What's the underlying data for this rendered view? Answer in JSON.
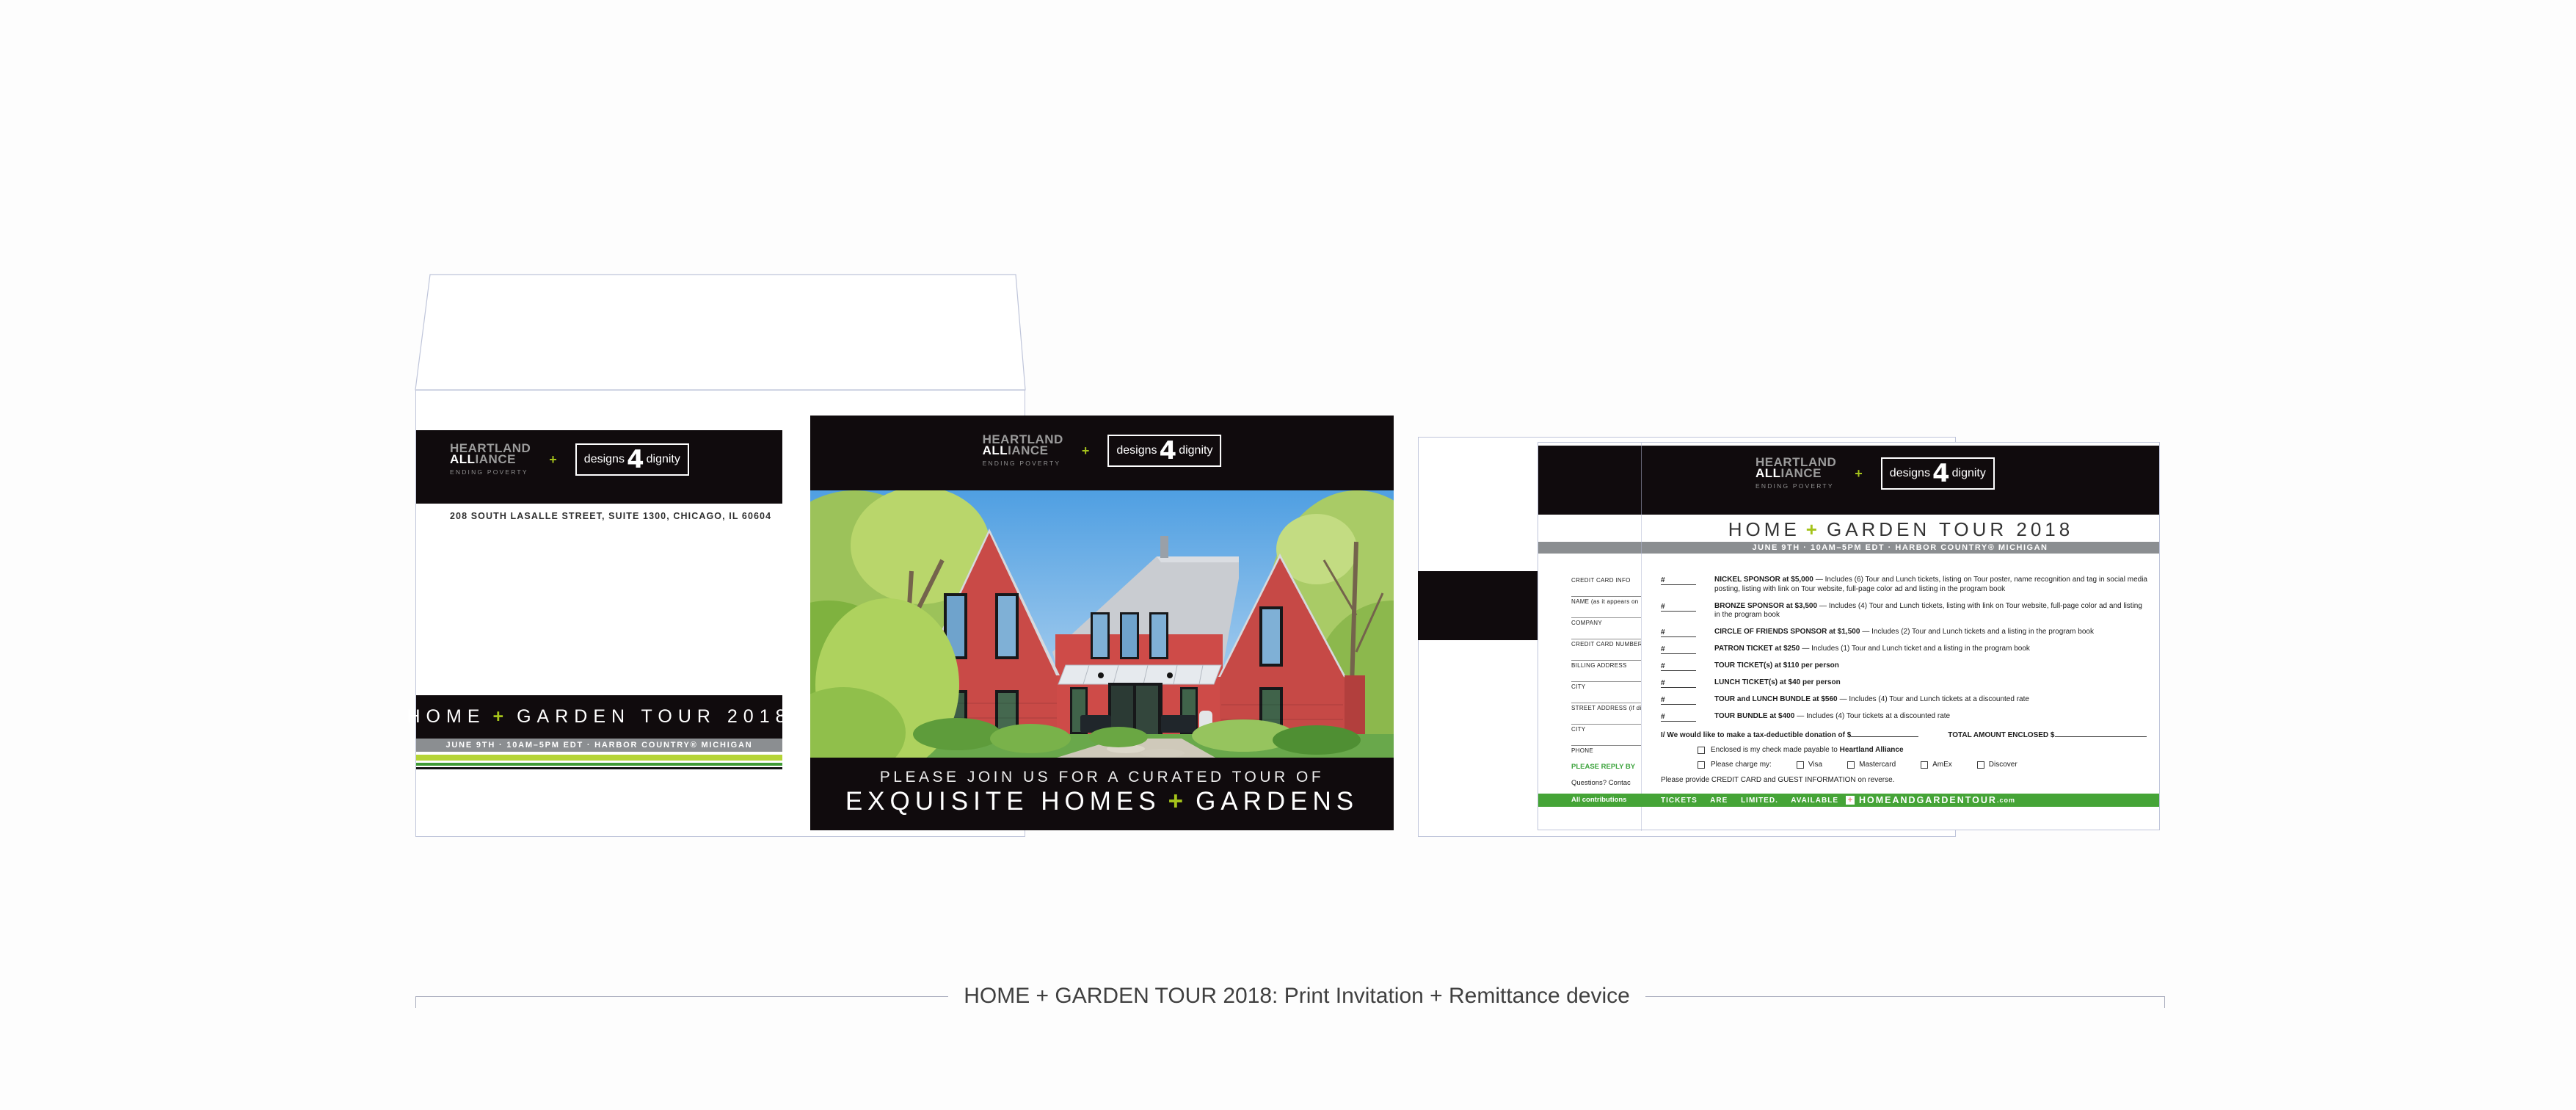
{
  "colors": {
    "ink_black": "#100b0d",
    "brand_green": "#a5c31b",
    "bar_green": "#45a437",
    "band_gray": "#8b8e91",
    "stripe_light": "#b5d437",
    "stripe_dark": "#3f9b35",
    "outline": "#bfc5da"
  },
  "brand": {
    "name_line1": "HEARTLAND",
    "name_line2_strong": "ALL",
    "name_line2_rest": "IANCE",
    "tagline": "ENDING POVERTY",
    "plus": "+",
    "d4d_left": "designs",
    "d4d_number": "4",
    "d4d_right": "dignity"
  },
  "tour": {
    "title_pre": "HOME",
    "title_plus": "+",
    "title_post": "GARDEN TOUR 2018",
    "date_line": "JUNE 9TH · 10AM–5PM EDT · HARBOR COUNTRY® MICHIGAN"
  },
  "envelope": {
    "address": "208 SOUTH LASALLE STREET, SUITE 1300, CHICAGO, IL  60604"
  },
  "invitation": {
    "kicker": "PLEASE JOIN US FOR A CURATED TOUR OF",
    "headline_pre": "EXQUISITE HOMES",
    "headline_plus": "+",
    "headline_post": "GARDENS"
  },
  "form": {
    "stub": {
      "fields": [
        "CREDIT CARD INFO",
        "NAME (as it appears on",
        "COMPANY",
        "CREDIT CARD NUMBER",
        "BILLING ADDRESS",
        "CITY",
        "STREET ADDRESS (if dif",
        "CITY",
        "PHONE"
      ],
      "reply_by": "PLEASE REPLY BY",
      "questions": "Questions? Contac",
      "contributions": "All contributions"
    },
    "items": [
      {
        "qty": "#",
        "name": "NICKEL SPONSOR at $5,000",
        "desc": "— Includes (6) Tour and Lunch tickets, listing on Tour poster, name recognition and tag in social media posting, listing with link on Tour website, full-page color ad and listing in the program book"
      },
      {
        "qty": "#",
        "name": "BRONZE SPONSOR at $3,500",
        "desc": "— Includes (4) Tour and Lunch tickets, listing with link on Tour website, full-page color ad and listing in the program book"
      },
      {
        "qty": "#",
        "name": "CIRCLE OF FRIENDS SPONSOR at $1,500",
        "desc": "— Includes (2) Tour and Lunch tickets and a listing in the program book"
      },
      {
        "qty": "#",
        "name": "PATRON TICKET at $250",
        "desc": "— Includes (1) Tour and Lunch ticket and a listing in the program book"
      },
      {
        "qty": "#",
        "name": "TOUR TICKET(s) at $110 per person",
        "desc": ""
      },
      {
        "qty": "#",
        "name": "LUNCH TICKET(s) at $40 per person",
        "desc": ""
      },
      {
        "qty": "#",
        "name": "TOUR and LUNCH BUNDLE at $560",
        "desc": "— Includes (4) Tour and Lunch tickets at a discounted rate"
      },
      {
        "qty": "#",
        "name": "TOUR BUNDLE at $400",
        "desc": "— Includes (4) Tour tickets at a discounted rate"
      }
    ],
    "donation": {
      "pre": "I/ We would like to make a tax-deductible donation of $",
      "total_label": "TOTAL AMOUNT ENCLOSED $"
    },
    "check": {
      "pre": "Enclosed is my check made payable to ",
      "bold": "Heartland Alliance"
    },
    "charge": {
      "label": "Please charge my:",
      "options": [
        "Visa",
        "Mastercard",
        "AmEx",
        "Discover"
      ]
    },
    "reverse_note": "Please provide CREDIT CARD and GUEST INFORMATION on reverse.",
    "bar": {
      "left": "TICKETS ARE LIMITED. AVAILABLE",
      "plus": "+",
      "site": "HOMEANDGARDENTOUR",
      "tld": ".com"
    }
  },
  "caption": "HOME + GARDEN TOUR 2018: Print Invitation + Remittance device"
}
